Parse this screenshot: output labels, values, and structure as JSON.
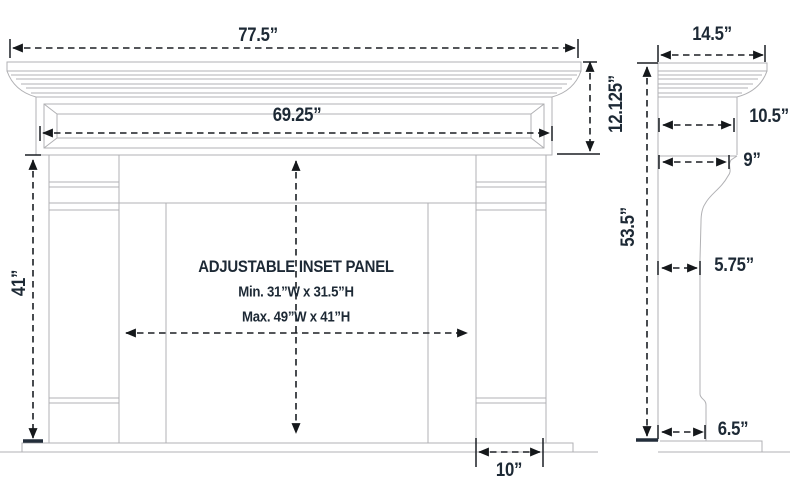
{
  "front_view": {
    "overall_width": "77.5”",
    "header_panel_width": "69.25”",
    "header_height": "12.125”",
    "leg_height": "41”",
    "leg_bottom_width": "10”",
    "inset_panel_title": "ADJUSTABLE INSET PANEL",
    "inset_panel_min": "Min. 31”W x 31.5”H",
    "inset_panel_max": "Max. 49”W x 41”H"
  },
  "side_view": {
    "shelf_depth": "14.5”",
    "header_depth": "10.5”",
    "header_bottom_depth": "9”",
    "overall_height": "53.5”",
    "leg_depth": "5.75”",
    "foot_depth": "6.5”"
  },
  "colors": {
    "label_text": "#1d2935",
    "dimension_line": "#1b1f24",
    "drawing_line": "#b1b1b4",
    "background": "#ffffff"
  }
}
